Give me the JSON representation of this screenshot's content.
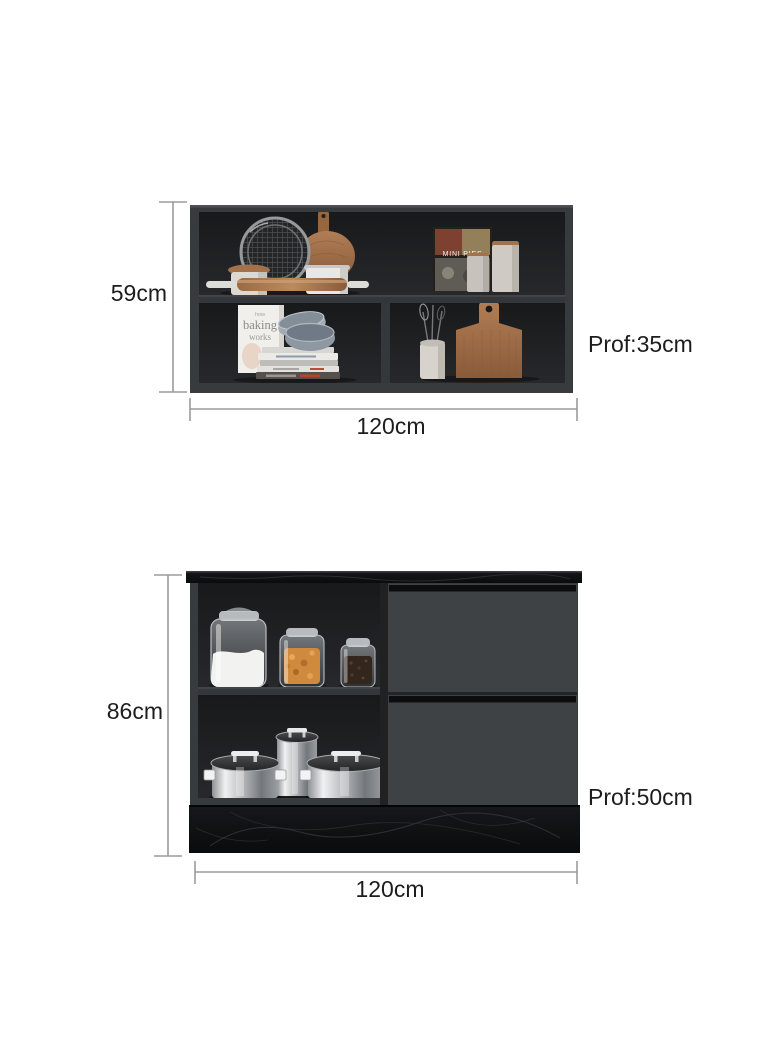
{
  "figures": [
    {
      "name": "wall-cabinet",
      "height_label": "59cm",
      "width_label": "120cm",
      "depth_label": "Prof:35cm",
      "decor": {
        "cookbook_title": "MINI PIES",
        "recipe_book_line1": "how",
        "recipe_book_line2": "baking",
        "recipe_book_line3": "works"
      }
    },
    {
      "name": "base-cabinet",
      "height_label": "86cm",
      "width_label": "120cm",
      "depth_label": "Prof:50cm"
    }
  ],
  "colors": {
    "background": "#ffffff",
    "cabinet_frame": "#383b3e",
    "cabinet_interior": "#1e2022",
    "shelf": "#33363a",
    "drawer_front": "#3f4245",
    "drawer_groove": "#0c0d0e",
    "marble_black": "#101113",
    "wood": "#a06c46",
    "steel": "#c9cbcd",
    "dimension_line": "#9b9b9b",
    "dimension_text": "#1d1d1d"
  }
}
